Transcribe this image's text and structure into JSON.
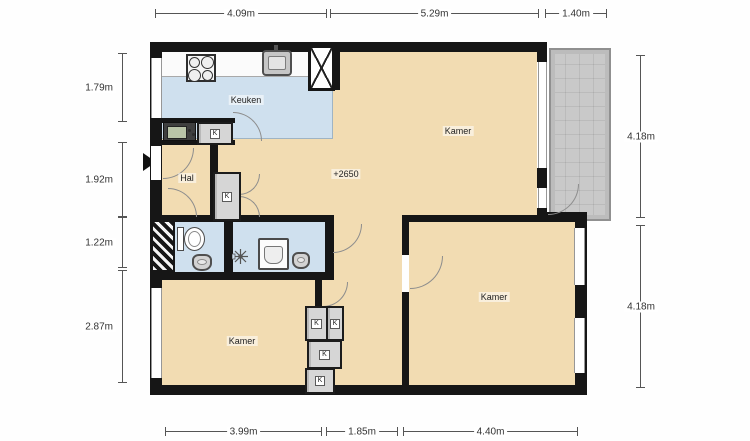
{
  "rooms": {
    "keuken": "Keuken",
    "hal": "Hal",
    "kamer_top": "Kamer",
    "kamer_bottom_left": "Kamer",
    "kamer_bottom_right": "Kamer",
    "level": "+2650"
  },
  "closets": [
    "K",
    "K",
    "K",
    "K",
    "K",
    "K"
  ],
  "dimensions": {
    "top": [
      "4.09m",
      "5.29m",
      "1.40m"
    ],
    "left": [
      "1.79m",
      "1.92m",
      "1.22m",
      "2.87m"
    ],
    "right": [
      "4.18m",
      "4.18m"
    ],
    "bottom": [
      "3.99m",
      "1.85m",
      "4.40m"
    ]
  },
  "colors": {
    "wall": "#161616",
    "room": "#f2dcb2",
    "wet_room": "#cfe0ee",
    "balcony": "#c9c9c9"
  }
}
